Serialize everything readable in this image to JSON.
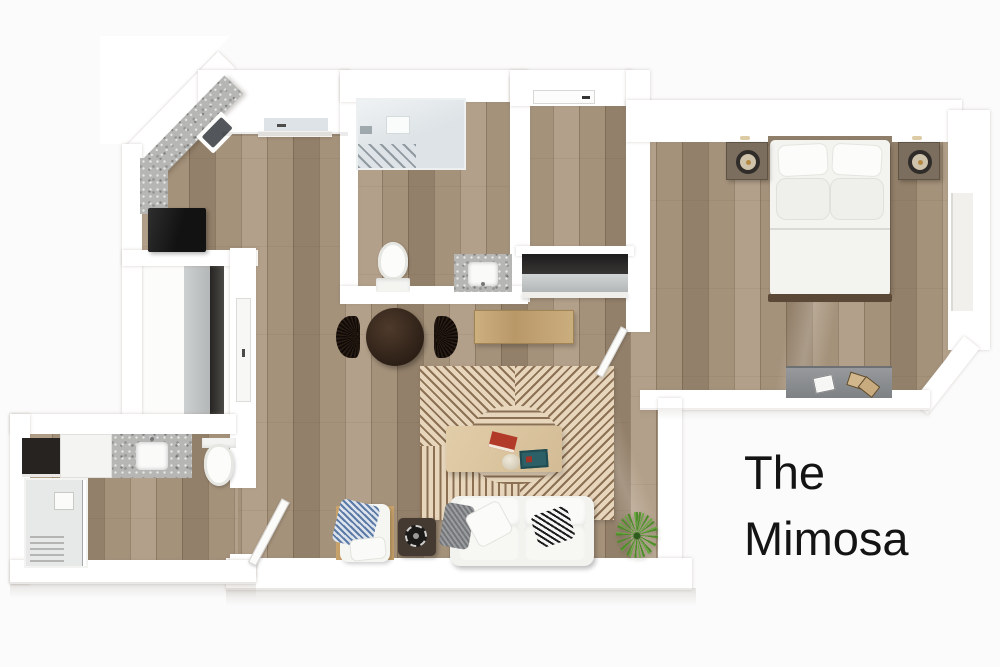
{
  "title": {
    "line1": "The",
    "line2": "Mimosa"
  },
  "colors": {
    "bg": "#fbfbfb",
    "wall": "#ffffff",
    "text": "#141414",
    "floor-base": "#a5927b",
    "floor-light": "#b3a08a",
    "floor-dark": "#93806a",
    "granite": "#b6b6b4",
    "glass": "#dde3e6",
    "dark": "#1a1a1a",
    "rug-cream": "#e7d6bc",
    "rug-brown": "#8b7053",
    "wood-table": "#d8c19d",
    "wood-console": "#c3a273",
    "wood-dark": "#33251b",
    "sofa": "#f2f2ef",
    "green": "#55942e",
    "gold": "#c9ab7c"
  }
}
